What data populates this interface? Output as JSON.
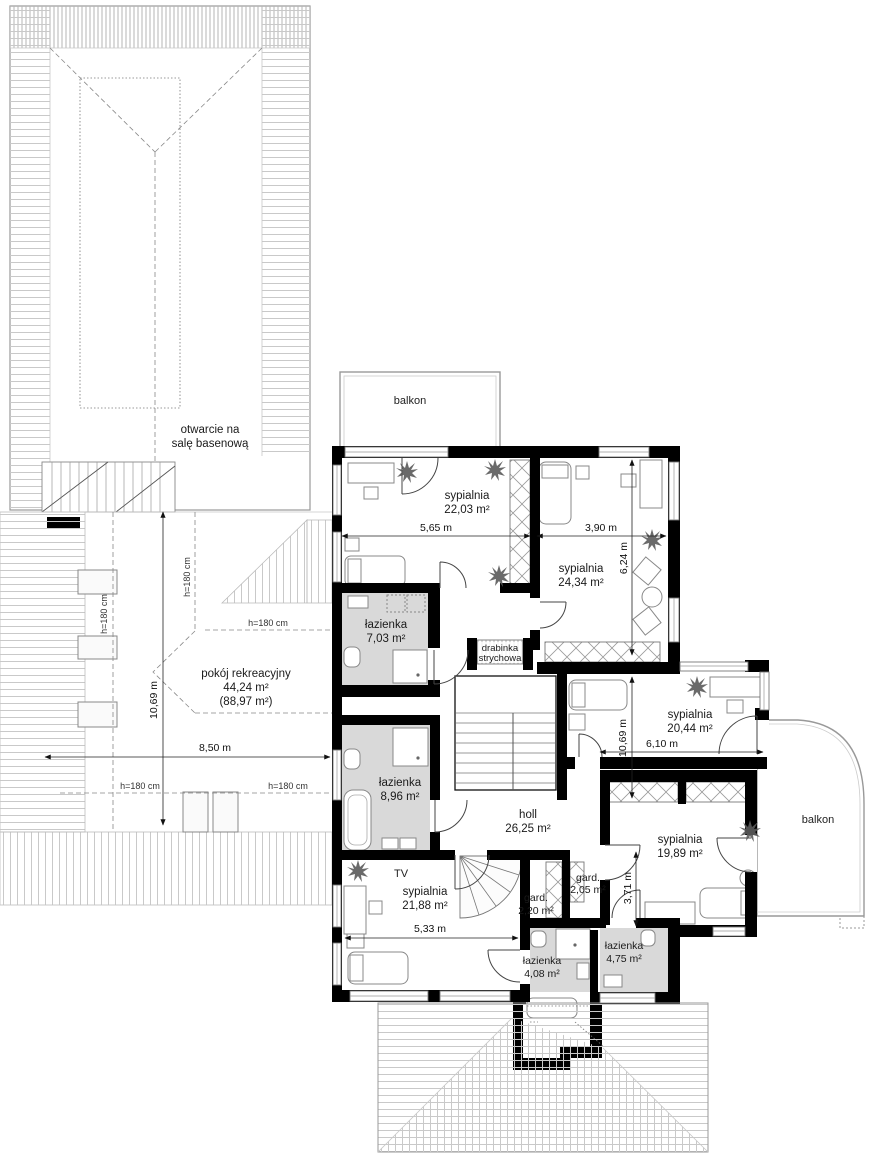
{
  "plan_type": "floor-plan-upper-storey",
  "labels": {
    "balkon_top": "balkon",
    "balkon_right": "balkon",
    "tv": "TV",
    "drabinka1": "drabinka",
    "drabinka2": "strychowa",
    "otwarcie1": "otwarcie na",
    "otwarcie2": "salę basenową"
  },
  "rooms": {
    "s2203": {
      "name": "sypialnia",
      "area": "22,03 m²"
    },
    "s2434": {
      "name": "sypialnia",
      "area": "24,34 m²"
    },
    "l703": {
      "name": "łazienka",
      "area": "7,03 m²"
    },
    "s2044": {
      "name": "sypialnia",
      "area": "20,44 m²"
    },
    "l896": {
      "name": "łazienka",
      "area": "8,96 m²"
    },
    "holl": {
      "name": "holl",
      "area": "26,25 m²"
    },
    "s1989": {
      "name": "sypialnia",
      "area": "19,89 m²"
    },
    "s2188": {
      "name": "sypialnia",
      "area": "21,88 m²"
    },
    "g220": {
      "name": "gard.",
      "area": "2,20 m²"
    },
    "g205": {
      "name": "gard.",
      "area": "2,05 m²"
    },
    "l408": {
      "name": "łazienka",
      "area": "4,08 m²"
    },
    "l475": {
      "name": "łazienka",
      "area": "4,75 m²"
    },
    "rek": {
      "name": "pokój rekreacyjny",
      "area": "44,24 m²",
      "area2": "(88,97 m²)"
    }
  },
  "dims": {
    "w565": "5,65 m",
    "w390": "3,90 m",
    "h624": "6,24 m",
    "h1069r": "10,69 m",
    "w610": "6,10 m",
    "h1069l": "10,69 m",
    "w850": "8,50 m",
    "w533": "5,33 m",
    "h371": "3,71 m",
    "h180": "h=180 cm"
  },
  "colors": {
    "wall": "#000000",
    "bath_floor": "#d9d9d9",
    "roof_hatch": "#c9c9c9",
    "paper": "#ffffff"
  }
}
